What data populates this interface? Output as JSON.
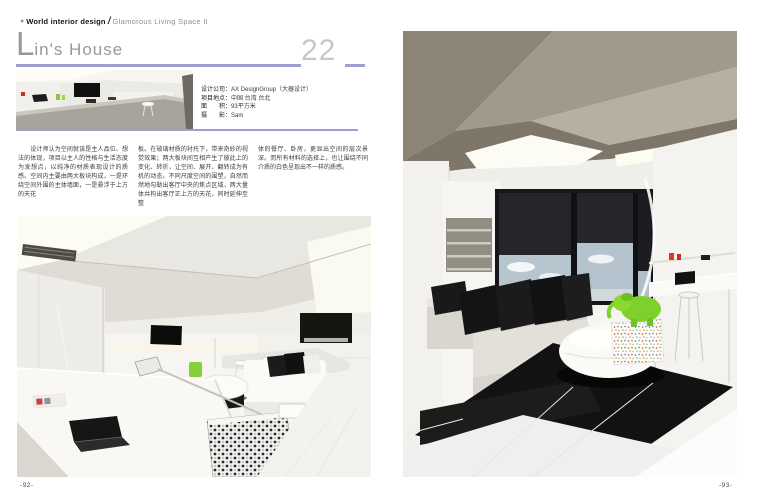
{
  "header": {
    "bullet_icon": "●",
    "magazine": "World interior design",
    "slash": "/",
    "series": "Glamorous Living Space II"
  },
  "title": {
    "initial": "L",
    "rest": "in's House",
    "chapter_number": "22"
  },
  "info": {
    "rows": [
      {
        "label": "设计公司：",
        "value": "AX DesignGroup（大器设计）"
      },
      {
        "label": "项目地点：",
        "value": "中国 台湾 台北"
      },
      {
        "label": "面　　积：",
        "value": "93平方米"
      },
      {
        "label": "摄　　影：",
        "value": "Sam"
      }
    ]
  },
  "article": {
    "columns": [
      "　　设计师认为空间就该是主人品位、想法的体现，项目以主人的性格与生活态度为发想点，以纯净的材质表现设计的质感。空间内主要由两大板块构成，一是环绕空间外围的主体墙面，一是悬浮于上方的天花",
      "板。在玻璃材质的衬托下，带来奇妙的视觉效果；两大板块间互相产生了彼此上的变化、转折，让空间、展开、翻转成为有机的动态。不同尺度空间的围塑，自然而然地勾勒出客厅中央的焦点区域，两大量体共构出客厅正上方的天花，同时延伸至整",
      "体的餐厅、卧房，更显出空间的层次景深。而所有材料的选择上，也让围绕不同介质的白色呈现出不一样的质感。"
    ]
  },
  "footer": {
    "left_page_number": "-92-",
    "right_page_number": "-93-"
  },
  "colors": {
    "accent_purple": "#9e9ed2",
    "title_gray": "#97989c",
    "chapter_number_gray": "#c7c7cb"
  }
}
